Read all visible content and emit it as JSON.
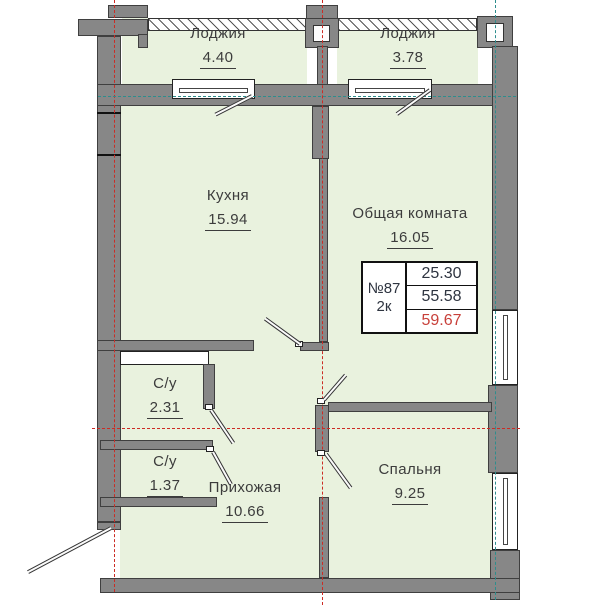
{
  "colors": {
    "room_fill": "#e9f2de",
    "wall_fill": "#878787",
    "wall_edge": "#3f3f3f",
    "axis_red": "#cc2b24",
    "axis_teal": "#2e8d8d",
    "area_total_red": "#c8403a",
    "text": "#3c3c3c"
  },
  "rooms": {
    "loggia_left": {
      "name": "Лоджия",
      "area": "4.40"
    },
    "loggia_right": {
      "name": "Лоджия",
      "area": "3.78"
    },
    "kitchen": {
      "name": "Кухня",
      "area": "15.94"
    },
    "living_room": {
      "name": "Общая комната",
      "area": "16.05"
    },
    "bathroom_upper": {
      "name": "С/у",
      "area": "2.31"
    },
    "bathroom_lower": {
      "name": "С/у",
      "area": "1.37"
    },
    "hallway": {
      "name": "Прихожая",
      "area": "10.66"
    },
    "bedroom": {
      "name": "Спальня",
      "area": "9.25"
    }
  },
  "info": {
    "number": "№87",
    "rooms_label": "2к",
    "area_row1": "25.30",
    "area_row2": "55.58",
    "area_row3": "59.67"
  }
}
